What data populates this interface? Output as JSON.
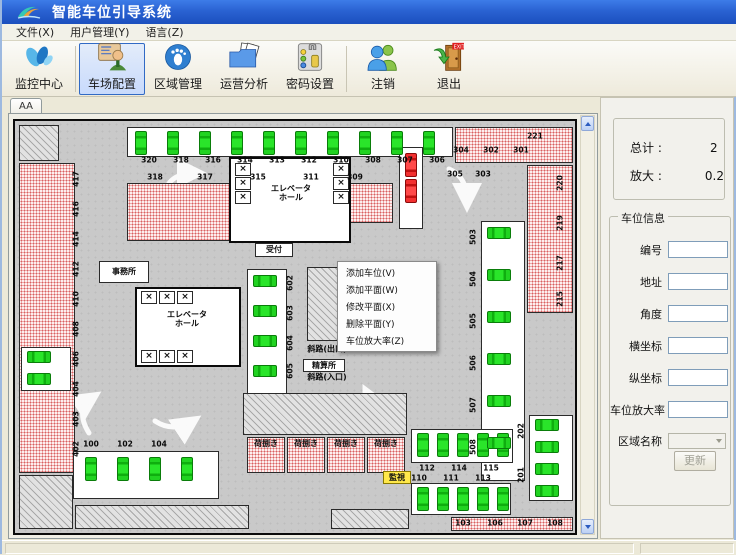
{
  "window": {
    "title": "智能车位引导系统"
  },
  "colors": {
    "titlebar": "#2a62d2",
    "free_spot_green": "#1ecb1e",
    "occupied_red": "#e02020",
    "reserved_pink": "#d96060",
    "selection_blue": "#316ac5",
    "monitor_tag_yellow": "#ffe84a"
  },
  "menu_bar": {
    "items": [
      {
        "label": "文件(X)"
      },
      {
        "label": "用户管理(Y)"
      },
      {
        "label": "语言(Z)"
      }
    ]
  },
  "toolbar": {
    "buttons": [
      {
        "label": "监控中心",
        "icon": "monitor-center-icon",
        "selected": false
      },
      {
        "label": "车场配置",
        "icon": "lot-config-icon",
        "selected": true
      },
      {
        "label": "区域管理",
        "icon": "area-manage-icon",
        "selected": false
      },
      {
        "label": "运营分析",
        "icon": "operation-analysis-icon",
        "selected": false
      },
      {
        "label": "密码设置",
        "icon": "password-settings-icon",
        "selected": false
      },
      {
        "label": "注销",
        "icon": "logout-icon",
        "selected": false
      },
      {
        "label": "退出",
        "icon": "exit-icon",
        "selected": false
      }
    ]
  },
  "tabs": {
    "active": "AA"
  },
  "context_menu": {
    "items": [
      "添加车位(V)",
      "添加平面(W)",
      "修改平面(X)",
      "删除平面(Y)",
      "车位放大率(Z)"
    ]
  },
  "side_panel": {
    "summary": {
      "total_label": "总计 :",
      "total_value": "2",
      "zoom_label": "放大 :",
      "zoom_value": "0.2"
    },
    "spot_info": {
      "title": "车位信息",
      "fields": [
        {
          "label": "编号",
          "value": ""
        },
        {
          "label": "地址",
          "value": ""
        },
        {
          "label": "角度",
          "value": ""
        },
        {
          "label": "横坐标",
          "value": ""
        },
        {
          "label": "纵坐标",
          "value": ""
        },
        {
          "label": "车位放大率",
          "value": ""
        },
        {
          "label": "区域名称",
          "value": "",
          "type": "select"
        }
      ],
      "update_button": "更新"
    }
  },
  "map": {
    "cells": [
      [
        "w",
        112,
        6,
        326,
        30
      ],
      [
        "p",
        440,
        6,
        118,
        36
      ],
      [
        "h",
        4,
        4,
        40,
        36
      ],
      [
        "p",
        4,
        42,
        56,
        310
      ],
      [
        "p",
        112,
        62,
        160,
        58
      ],
      [
        "p",
        282,
        62,
        96,
        40
      ],
      [
        "p",
        512,
        44,
        46,
        148
      ],
      [
        "w",
        384,
        26,
        24,
        82
      ],
      [
        "e",
        214,
        36,
        122,
        86
      ],
      [
        "e",
        120,
        166,
        106,
        80
      ],
      [
        "w",
        232,
        148,
        40,
        128
      ],
      [
        "w",
        84,
        140,
        50,
        22,
        "事務所"
      ],
      [
        "w",
        240,
        122,
        38,
        14,
        "受付"
      ],
      [
        "h",
        292,
        146,
        102,
        74
      ],
      [
        "s",
        338,
        186,
        48,
        32
      ],
      [
        "w",
        288,
        238,
        42,
        13,
        "精算所"
      ],
      [
        "w",
        6,
        226,
        50,
        44
      ],
      [
        "w",
        466,
        100,
        44,
        260
      ],
      [
        "w",
        514,
        294,
        44,
        86
      ],
      [
        "h",
        4,
        354,
        54,
        54
      ],
      [
        "w",
        58,
        330,
        146,
        48
      ],
      [
        "h",
        60,
        384,
        174,
        24
      ],
      [
        "h",
        228,
        272,
        164,
        42
      ],
      [
        "l",
        232,
        316,
        38,
        36,
        "荷捌き"
      ],
      [
        "l",
        272,
        316,
        38,
        36,
        "荷捌き"
      ],
      [
        "l",
        312,
        316,
        38,
        36,
        "荷捌き"
      ],
      [
        "l",
        352,
        316,
        38,
        36,
        "荷捌き"
      ],
      [
        "y",
        368,
        350,
        28,
        13,
        "監視"
      ],
      [
        "w",
        396,
        308,
        102,
        34
      ],
      [
        "w",
        396,
        362,
        100,
        32
      ],
      [
        "p",
        436,
        396,
        122,
        14
      ],
      [
        "h",
        316,
        388,
        78,
        20
      ],
      [
        "x",
        220,
        42,
        16,
        13,
        "×"
      ],
      [
        "x",
        220,
        56,
        16,
        13,
        "×"
      ],
      [
        "x",
        220,
        70,
        16,
        13,
        "×"
      ],
      [
        "x",
        318,
        42,
        16,
        13,
        "×"
      ],
      [
        "x",
        318,
        56,
        16,
        13,
        "×"
      ],
      [
        "x",
        318,
        70,
        16,
        13,
        "×"
      ],
      [
        "x",
        126,
        170,
        16,
        13,
        "×"
      ],
      [
        "x",
        144,
        170,
        16,
        13,
        "×"
      ],
      [
        "x",
        162,
        170,
        16,
        13,
        "×"
      ],
      [
        "x",
        126,
        229,
        16,
        13,
        "×"
      ],
      [
        "x",
        144,
        229,
        16,
        13,
        "×"
      ],
      [
        "x",
        162,
        229,
        16,
        13,
        "×"
      ]
    ],
    "vcars": [
      [
        120,
        10
      ],
      [
        152,
        10
      ],
      [
        184,
        10
      ],
      [
        216,
        10
      ],
      [
        248,
        10
      ],
      [
        280,
        10
      ],
      [
        312,
        10
      ],
      [
        344,
        10
      ],
      [
        376,
        10
      ],
      [
        408,
        10
      ],
      [
        70,
        336
      ],
      [
        102,
        336
      ],
      [
        134,
        336
      ],
      [
        166,
        336
      ],
      [
        402,
        312
      ],
      [
        422,
        312
      ],
      [
        442,
        312
      ],
      [
        462,
        312
      ],
      [
        482,
        312
      ],
      [
        402,
        366
      ],
      [
        422,
        366
      ],
      [
        442,
        366
      ],
      [
        462,
        366
      ],
      [
        482,
        366
      ]
    ],
    "hcars": [
      [
        472,
        106
      ],
      [
        472,
        148
      ],
      [
        472,
        190
      ],
      [
        472,
        232
      ],
      [
        472,
        274
      ],
      [
        472,
        316
      ],
      [
        520,
        298
      ],
      [
        520,
        320
      ],
      [
        520,
        342
      ],
      [
        520,
        364
      ],
      [
        12,
        230
      ],
      [
        12,
        252
      ],
      [
        238,
        154
      ],
      [
        238,
        184
      ],
      [
        238,
        214
      ],
      [
        238,
        244
      ]
    ],
    "rcars": [
      [
        390,
        32
      ],
      [
        390,
        58
      ]
    ],
    "labels": [
      [
        134,
        40,
        "320",
        "n"
      ],
      [
        166,
        40,
        "318",
        "n"
      ],
      [
        198,
        40,
        "316",
        "n"
      ],
      [
        230,
        40,
        "314",
        "n"
      ],
      [
        262,
        40,
        "313",
        "n"
      ],
      [
        294,
        40,
        "312",
        "n"
      ],
      [
        326,
        40,
        "310",
        "n"
      ],
      [
        358,
        40,
        "308",
        "n"
      ],
      [
        390,
        40,
        "307",
        "n"
      ],
      [
        422,
        40,
        "306",
        "n"
      ],
      [
        520,
        16,
        "221",
        "n"
      ],
      [
        446,
        30,
        "304",
        "n"
      ],
      [
        476,
        30,
        "302",
        "n"
      ],
      [
        506,
        30,
        "301",
        "n"
      ],
      [
        140,
        57,
        "318",
        "n"
      ],
      [
        190,
        57,
        "317",
        "n"
      ],
      [
        243,
        57,
        "315",
        "n"
      ],
      [
        296,
        57,
        "311",
        "n"
      ],
      [
        340,
        57,
        "309",
        "n"
      ],
      [
        440,
        54,
        "305",
        "n"
      ],
      [
        468,
        54,
        "303",
        "n"
      ],
      [
        62,
        58,
        "417",
        "r"
      ],
      [
        62,
        88,
        "416",
        "r"
      ],
      [
        62,
        118,
        "414",
        "r"
      ],
      [
        62,
        148,
        "412",
        "r"
      ],
      [
        62,
        178,
        "410",
        "r"
      ],
      [
        62,
        208,
        "408",
        "r"
      ],
      [
        62,
        238,
        "406",
        "r"
      ],
      [
        62,
        268,
        "404",
        "r"
      ],
      [
        62,
        298,
        "403",
        "r"
      ],
      [
        62,
        328,
        "402",
        "r"
      ],
      [
        546,
        62,
        "220",
        "r"
      ],
      [
        546,
        102,
        "219",
        "r"
      ],
      [
        546,
        142,
        "217",
        "r"
      ],
      [
        546,
        178,
        "215",
        "r"
      ],
      [
        459,
        116,
        "503",
        "r"
      ],
      [
        459,
        158,
        "504",
        "r"
      ],
      [
        459,
        200,
        "505",
        "r"
      ],
      [
        459,
        242,
        "506",
        "r"
      ],
      [
        459,
        284,
        "507",
        "r"
      ],
      [
        459,
        326,
        "508",
        "r"
      ],
      [
        276,
        162,
        "602",
        "r"
      ],
      [
        276,
        192,
        "603",
        "r"
      ],
      [
        276,
        222,
        "604",
        "r"
      ],
      [
        276,
        250,
        "605",
        "r"
      ],
      [
        507,
        310,
        "202",
        "r"
      ],
      [
        507,
        354,
        "201",
        "r"
      ],
      [
        76,
        324,
        "100",
        "n"
      ],
      [
        110,
        324,
        "102",
        "n"
      ],
      [
        144,
        324,
        "104",
        "n"
      ],
      [
        412,
        348,
        "112",
        "n"
      ],
      [
        444,
        348,
        "114",
        "n"
      ],
      [
        476,
        348,
        "115",
        "n"
      ],
      [
        404,
        358,
        "110",
        "n"
      ],
      [
        436,
        358,
        "111",
        "n"
      ],
      [
        468,
        358,
        "113",
        "n"
      ],
      [
        448,
        403,
        "103",
        "n"
      ],
      [
        480,
        403,
        "106",
        "n"
      ],
      [
        510,
        403,
        "107",
        "n"
      ],
      [
        540,
        403,
        "108",
        "n"
      ],
      [
        276,
        72,
        "エレベータ\nホール",
        "a"
      ],
      [
        172,
        198,
        "エレベータ\nホール",
        "a"
      ],
      [
        312,
        228,
        "斜路(出口)",
        "a"
      ],
      [
        312,
        256,
        "斜路(入口)",
        "a"
      ]
    ]
  }
}
